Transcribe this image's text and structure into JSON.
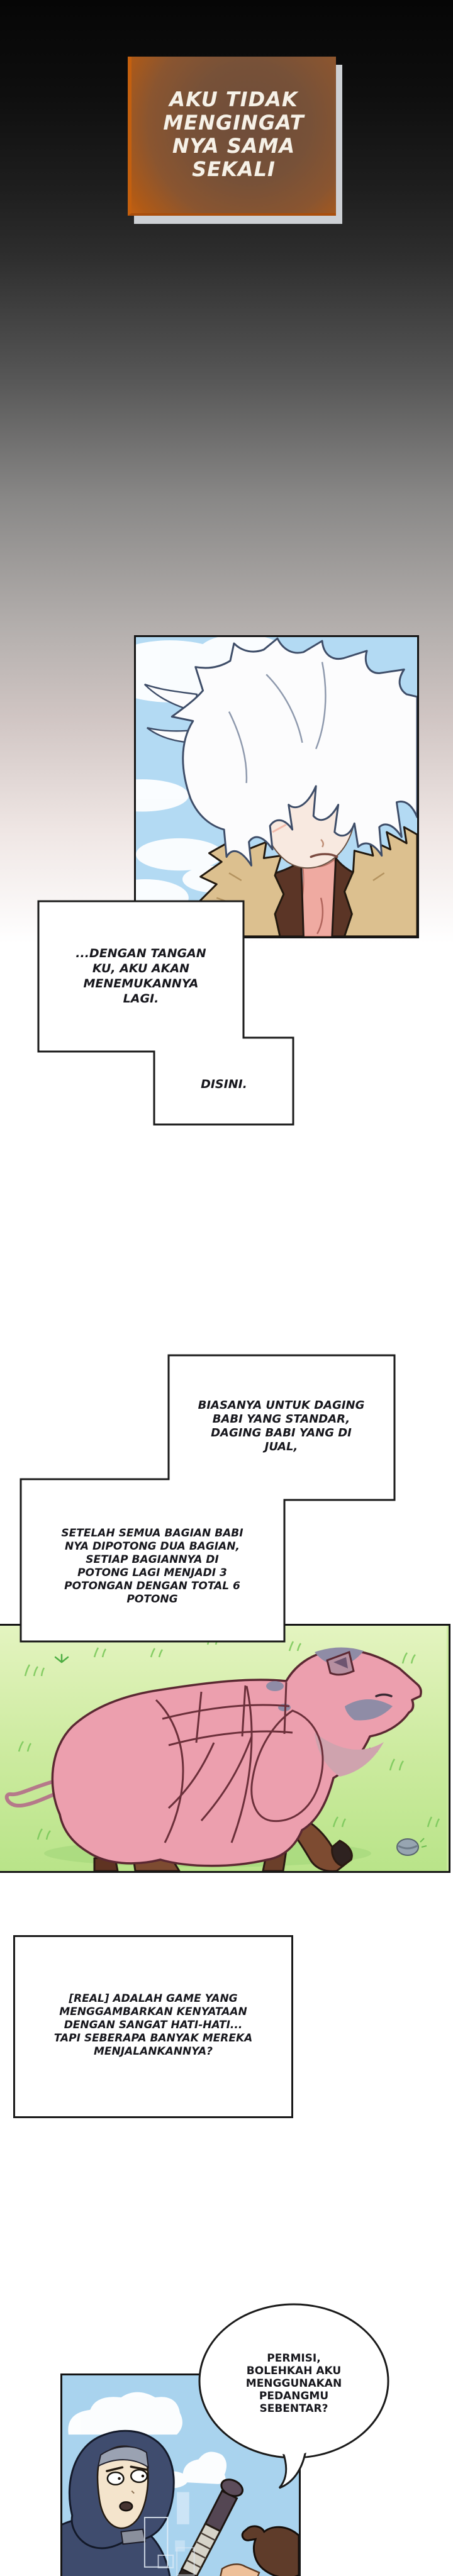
{
  "caption": {
    "text": "AKU TIDAK\nMENGINGAT\nNYA SAMA\nSEKALI"
  },
  "bubble1a": {
    "text": "...DENGAN TANGAN\nKU, AKU AKAN\nMENEMUKANNYA\nLAGI."
  },
  "bubble1b": {
    "text": "DISINI."
  },
  "bubble2a": {
    "text": "BIASANYA UNTUK DAGING\nBABI YANG STANDAR,\nDAGING BABI YANG DI\nJUAL,"
  },
  "bubble2b": {
    "text": "SETELAH SEMUA BAGIAN BABI\nNYA DIPOTONG DUA BAGIAN,\nSETIAP BAGIANNYA DI\nPOTONG LAGI MENJADI 3\nPOTONGAN DENGAN TOTAL 6\nPOTONG"
  },
  "bubble3": {
    "text": "[REAL] ADALAH GAME YANG\nMENGGAMBARKAN KENYATAAN\nDENGAN SANGAT HATI-HATI...\nTAPI SEBERAPA BANYAK MEREKA\nMENJALANKANNYA?"
  },
  "balloon": {
    "text": "PERMISI,\nBOLEHKAH AKU\nMENGGUNAKAN\nPEDANGMU\nSEBENTAR?"
  },
  "colors": {
    "caption_bg": "#775138",
    "caption_edge": "#c05f12",
    "caption_text": "#f6f1e7",
    "sky": "#b3daf3",
    "sky_bottom": "#a9d3ee",
    "grass_light": "#e4f4c0",
    "grass_dark": "#b9e489",
    "pig_pink": "#ec9fae",
    "pig_outline": "#5b2832",
    "pig_patch_gray": "#8f8ca6",
    "hoof_brown": "#7d4b31",
    "fur_collar": "#dcc08f",
    "jacket_green": "#3d5042",
    "shirt_brown": "#5b3526",
    "hood_navy": "#3f4c6e",
    "bubble_border": "#1a1a1a"
  }
}
